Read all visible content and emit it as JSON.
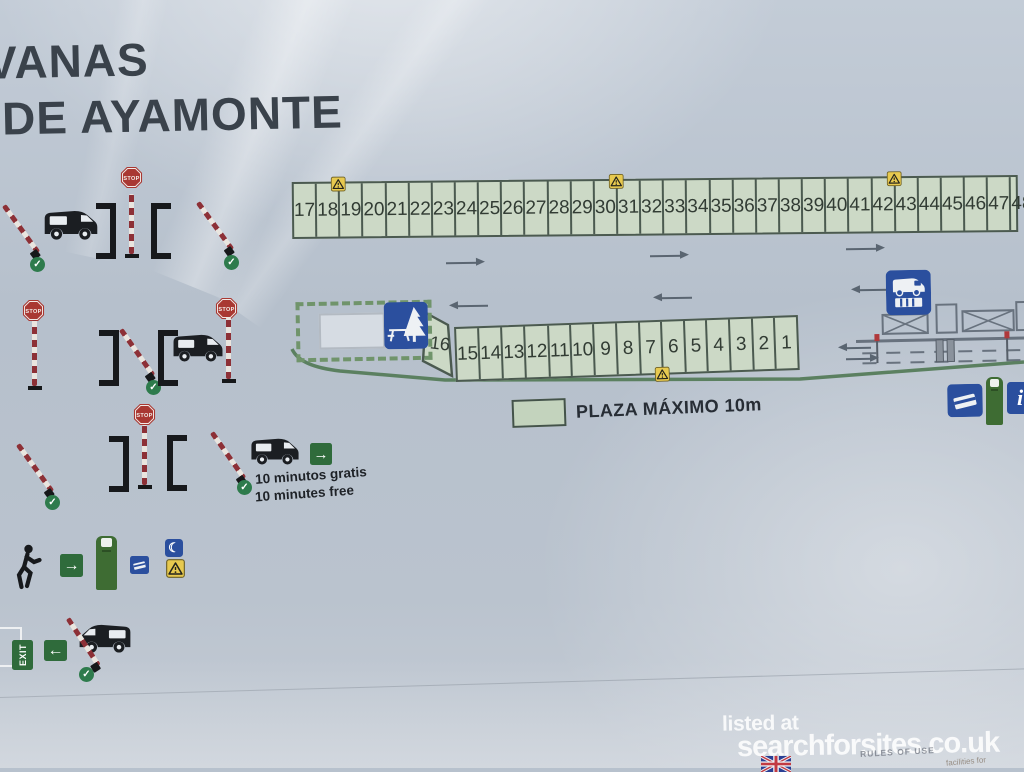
{
  "title": {
    "line1": "VANAS",
    "line2": "DE AYAMONTE"
  },
  "top_row": {
    "numbers": [
      17,
      18,
      19,
      20,
      21,
      22,
      23,
      24,
      25,
      26,
      27,
      28,
      29,
      30,
      31,
      32,
      33,
      34,
      35,
      36,
      37,
      38,
      39,
      40,
      41,
      42,
      43,
      44,
      45,
      46,
      47,
      48
    ],
    "warning_after": [
      18,
      30,
      42
    ]
  },
  "bottom_row": {
    "numbers": [
      15,
      14,
      13,
      12,
      11,
      10,
      9,
      8,
      7,
      6,
      5,
      4,
      3,
      2,
      1
    ],
    "corner": "16",
    "warning_after": [
      7
    ]
  },
  "legend": {
    "label": "PLAZA MÁXIMO 10m"
  },
  "free_stay": {
    "es": "10 minutos gratis",
    "en": "10 minutes free"
  },
  "labels": {
    "stop": "STOP",
    "exit": "EXIT"
  },
  "icons": {
    "check": "✓",
    "arrow_right": "→",
    "arrow_left": "←",
    "info": "i",
    "moon": "☾",
    "warning": "warning-triangle",
    "van": "motorhome",
    "pedestrian": "walking-person",
    "picnic": "picnic-area",
    "service": "motorhome-service-point",
    "card": "payment-card",
    "flag": "uk-flag"
  },
  "watermark": {
    "prefix": "listed at",
    "site": "searchforsites.co.uk"
  },
  "fine_print": {
    "center": "RULES OF USE",
    "right": "facilities for"
  },
  "colors": {
    "board_grey": "#b7c1cd",
    "plaza_green": "#ccd9c6",
    "border_green": "#4b5a50",
    "line_green": "#5b8060",
    "sign_blue": "#2b4f9e",
    "sign_green": "#2f6b3b",
    "stop_red": "#a93832",
    "barrier_red": "#8d3036",
    "check_green": "#2e7b4c",
    "warning_yellow": "#e7c94f",
    "ink": "#17191c",
    "arrow_grey": "#5a6571"
  }
}
